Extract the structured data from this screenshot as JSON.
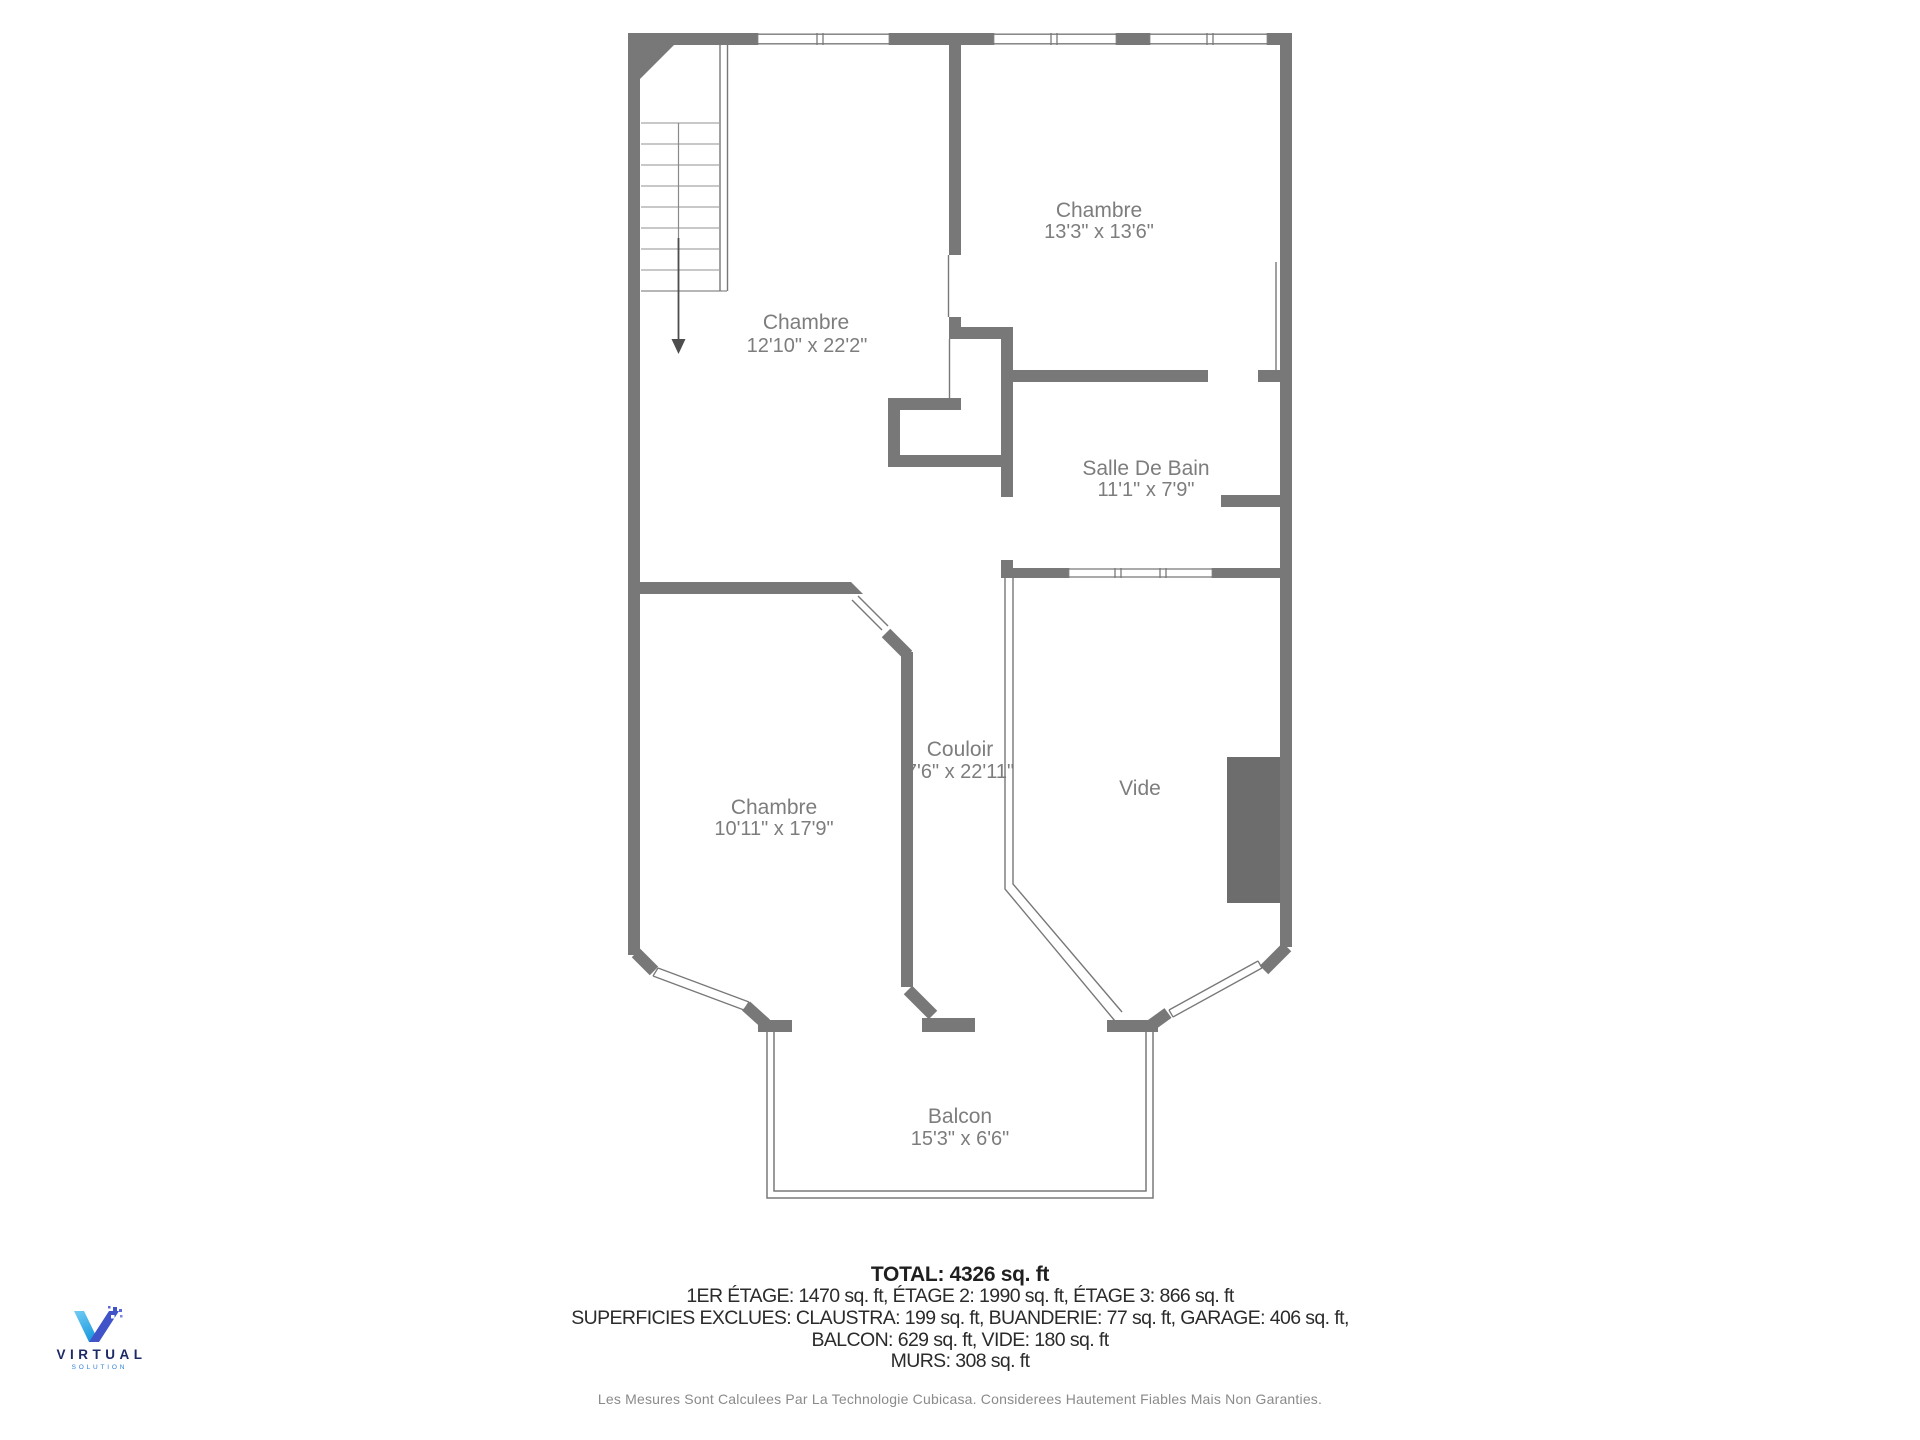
{
  "floorplan": {
    "rooms": [
      {
        "name": "Chambre",
        "dims": "13'3\" x 13'6\""
      },
      {
        "name": "Chambre",
        "dims": "12'10\" x 22'2\""
      },
      {
        "name": "Salle De Bain",
        "dims": "11'1\" x 7'9\""
      },
      {
        "name": "Couloir",
        "dims": "7'6\" x 22'11\""
      },
      {
        "name": "Vide",
        "dims": ""
      },
      {
        "name": "Chambre",
        "dims": "10'11\" x 17'9\""
      },
      {
        "name": "Balcon",
        "dims": "15'3\" x 6'6\""
      }
    ]
  },
  "summary": {
    "total": "TOTAL: 4326 sq. ft",
    "line1": "1ER ÉTAGE: 1470 sq. ft, ÉTAGE 2: 1990 sq. ft, ÉTAGE 3: 866 sq. ft",
    "line2": "SUPERFICIES EXCLUES: CLAUSTRA: 199 sq. ft, BUANDERIE: 77 sq. ft, GARAGE: 406 sq. ft,",
    "line3": "BALCON: 629 sq. ft, VIDE: 180 sq. ft",
    "line4": "MURS: 308 sq. ft"
  },
  "footer": {
    "disclaimer": "Les Mesures Sont Calculees Par La Technologie Cubicasa. Considerees Hautement Fiables Mais Non Garanties."
  },
  "logo": {
    "brand": "VIRTUAL",
    "sub": "SOLUTION"
  },
  "colors": {
    "wall": "#787878",
    "dark_shaft": "#6d6d6d",
    "room_label": "#7d7d7d",
    "tread_line": "#a6a6a6",
    "arrow": "#4d4d4d",
    "summary_text": "#2b2b2b",
    "disclaimer_text": "#8a8a8a",
    "logo_navy": "#1c2a66",
    "logo_blue": "#2f80d9",
    "logo_light_blue": "#4eb7ee"
  }
}
